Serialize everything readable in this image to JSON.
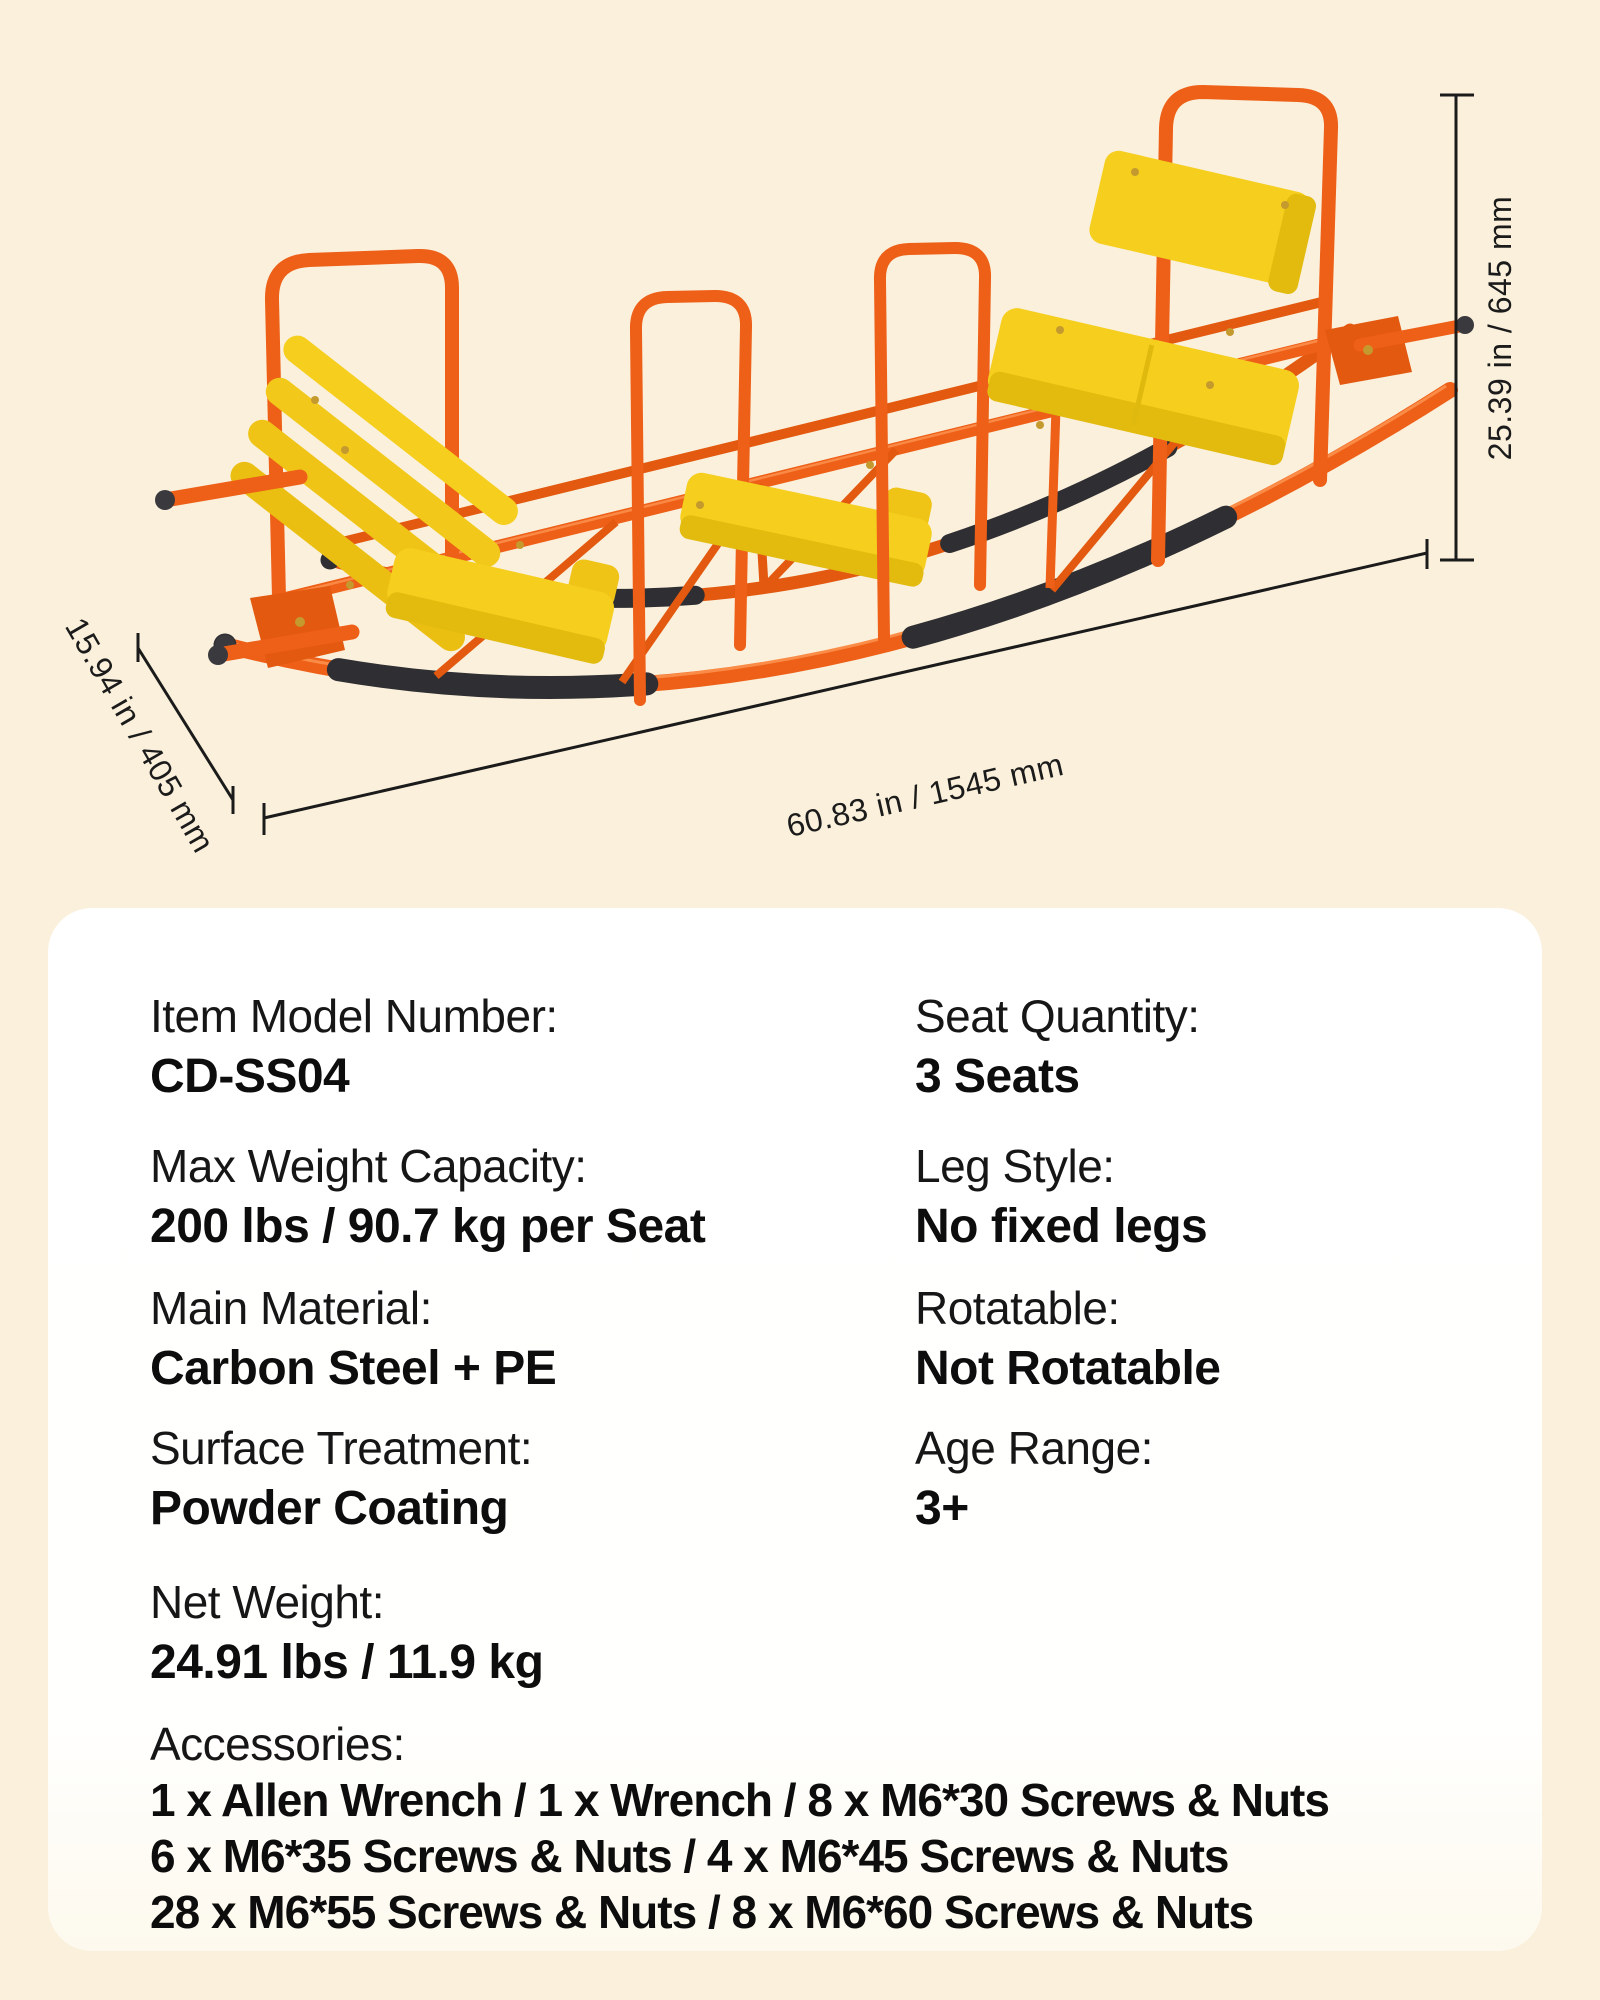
{
  "theme": {
    "background_cream": "#FAF0DB",
    "panel_white": "#FFFFFF",
    "text_black": "#111111",
    "frame_orange": "#EE5F17",
    "frame_orange_dark": "#D9500F",
    "seat_yellow": "#F5CE1E",
    "seat_yellow_dark": "#E2BB0E",
    "grip_black": "#2F2F33",
    "dimension_line": "#1B1B1B"
  },
  "product": {
    "description": "3-seat rocking seesaw with orange carbon steel frame, yellow PE seats and black foam grips"
  },
  "dimensions": {
    "height": "25.39 in / 645 mm",
    "length": "60.83 in / 1545 mm",
    "depth": "15.94 in / 405 mm"
  },
  "specs": {
    "left": [
      {
        "label": "Item Model Number:",
        "value": "CD-SS04"
      },
      {
        "label": "Max Weight Capacity:",
        "value": "200 lbs / 90.7 kg per Seat"
      },
      {
        "label": "Main Material:",
        "value": "Carbon Steel + PE"
      },
      {
        "label": "Surface Treatment:",
        "value": "Powder Coating"
      },
      {
        "label": "Net Weight:",
        "value": "24.91 lbs / 11.9 kg"
      }
    ],
    "right": [
      {
        "label": "Seat Quantity:",
        "value": "3 Seats"
      },
      {
        "label": "Leg Style:",
        "value": "No fixed legs"
      },
      {
        "label": "Rotatable:",
        "value": "Not Rotatable"
      },
      {
        "label": "Age Range:",
        "value": "3+"
      }
    ],
    "accessories": {
      "label": "Accessories:",
      "lines": [
        "1 x Allen Wrench / 1 x Wrench / 8 x M6*30 Screws & Nuts",
        "6 x M6*35 Screws & Nuts / 4 x M6*45 Screws & Nuts",
        "28 x M6*55 Screws & Nuts / 8 x M6*60 Screws & Nuts"
      ]
    }
  }
}
